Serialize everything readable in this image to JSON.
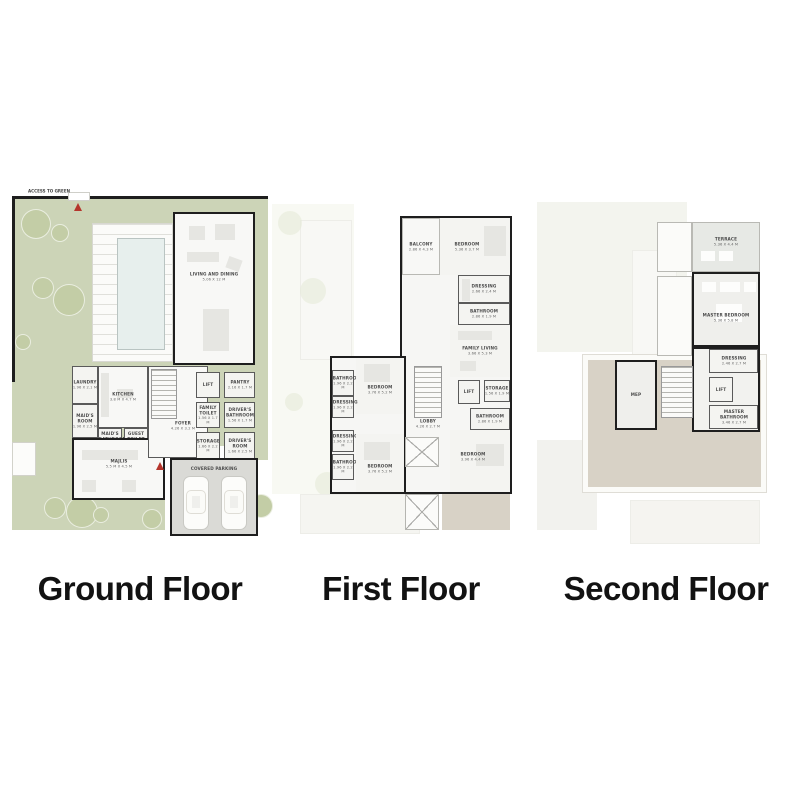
{
  "titles": {
    "ground": "Ground Floor",
    "first": "First Floor",
    "second": "Second Floor"
  },
  "colors": {
    "garden": "#ccd4b7",
    "tree": "#c3cda6",
    "wall": "#1e1e1e",
    "roof_tan": "#d8d2c6",
    "pool": "#e7efed",
    "parking": "#dadad6",
    "entrance_marker": "#b5352c"
  },
  "ground": {
    "access_label": "ACCESS TO GREEN",
    "rooms": {
      "living_dining": {
        "name": "LIVING AND DINING",
        "dims": "5.06 X 12 M"
      },
      "laundry": {
        "name": "LAUNDRY",
        "dims": "1.96 X 2.1 M"
      },
      "kitchen": {
        "name": "KITCHEN",
        "dims": "3.8 M X 4.7 M"
      },
      "maids_room": {
        "name": "MAID'S ROOM",
        "dims": "1.96 X 2.5 M"
      },
      "maids_bathroom": {
        "name": "MAID'S BATHROOM",
        "dims": "1.6 M X 1.7 M"
      },
      "guest_toilet": {
        "name": "GUEST TOILET",
        "dims": "2.06 X 1.7 M"
      },
      "majlis": {
        "name": "MAJLIS",
        "dims": "5.5 M X 4.5 M"
      },
      "foyer": {
        "name": "FOYER",
        "dims": "4.26 X 3.2 M"
      },
      "lift": {
        "name": "LIFT",
        "dims": ""
      },
      "pantry": {
        "name": "PANTRY",
        "dims": "2.16 X 1.7 M"
      },
      "family_toilet": {
        "name": "FAMILY TOILET",
        "dims": "1.56 X 1.7 M"
      },
      "drivers_bathroom": {
        "name": "DRIVER'S BATHROOM",
        "dims": "1.56 X 1.7 M"
      },
      "storage": {
        "name": "STORAGE",
        "dims": "1.66 X 2.2 M"
      },
      "drivers_room": {
        "name": "DRIVER'S ROOM",
        "dims": "1.66 X 2.5 M"
      },
      "covered_parking": {
        "name": "COVERED PARKING",
        "dims": ""
      }
    }
  },
  "first": {
    "rooms": {
      "balcony": {
        "name": "BALCONY",
        "dims": "2.86 X 4.3 M"
      },
      "bedroom_top": {
        "name": "BEDROOM",
        "dims": "5.36 X 3.7 M"
      },
      "dressing_top": {
        "name": "DRESSING",
        "dims": "2.66 X 2.4 M"
      },
      "bathroom_top": {
        "name": "BATHROOM",
        "dims": "2.86 X 1.9 M"
      },
      "family_living": {
        "name": "FAMILY LIVING",
        "dims": "3.66 X 5.3 M"
      },
      "lift": {
        "name": "LIFT",
        "dims": ""
      },
      "storage": {
        "name": "STORAGE",
        "dims": "1.56 X 1.9 M"
      },
      "bathroom_mid": {
        "name": "BATHROOM",
        "dims": "2.86 X 1.9 M"
      },
      "bedroom_right": {
        "name": "BEDROOM",
        "dims": "3.96 X 4.4 M"
      },
      "lobby": {
        "name": "LOBBY",
        "dims": "4.26 X 2.7 M"
      },
      "bathroom_left_top": {
        "name": "BATHROOM",
        "dims": "1.96 X 2.2 M"
      },
      "bedroom_left_top": {
        "name": "BEDROOM",
        "dims": "3.76 X 5.2 M"
      },
      "dressing_left_top": {
        "name": "DRESSING",
        "dims": "1.96 X 2.2 M"
      },
      "dressing_left_bottom": {
        "name": "DRESSING",
        "dims": "1.96 X 2.2 M"
      },
      "bathroom_left_bottom": {
        "name": "BATHROOM",
        "dims": "1.96 X 2.2 M"
      },
      "bedroom_left_bottom": {
        "name": "BEDROOM",
        "dims": "3.76 X 5.2 M"
      }
    }
  },
  "second": {
    "rooms": {
      "terrace": {
        "name": "TERRACE",
        "dims": "5.36 X 4.4 M"
      },
      "master_bedroom": {
        "name": "MASTER BEDROOM",
        "dims": "5.36 X 5.8 M"
      },
      "dressing": {
        "name": "DRESSING",
        "dims": "2.46 X 2.7 M"
      },
      "lift": {
        "name": "LIFT",
        "dims": ""
      },
      "master_bathroom": {
        "name": "MASTER BATHROOM",
        "dims": "3.46 X 2.7 M"
      },
      "mep": {
        "name": "MEP",
        "dims": ""
      }
    }
  }
}
